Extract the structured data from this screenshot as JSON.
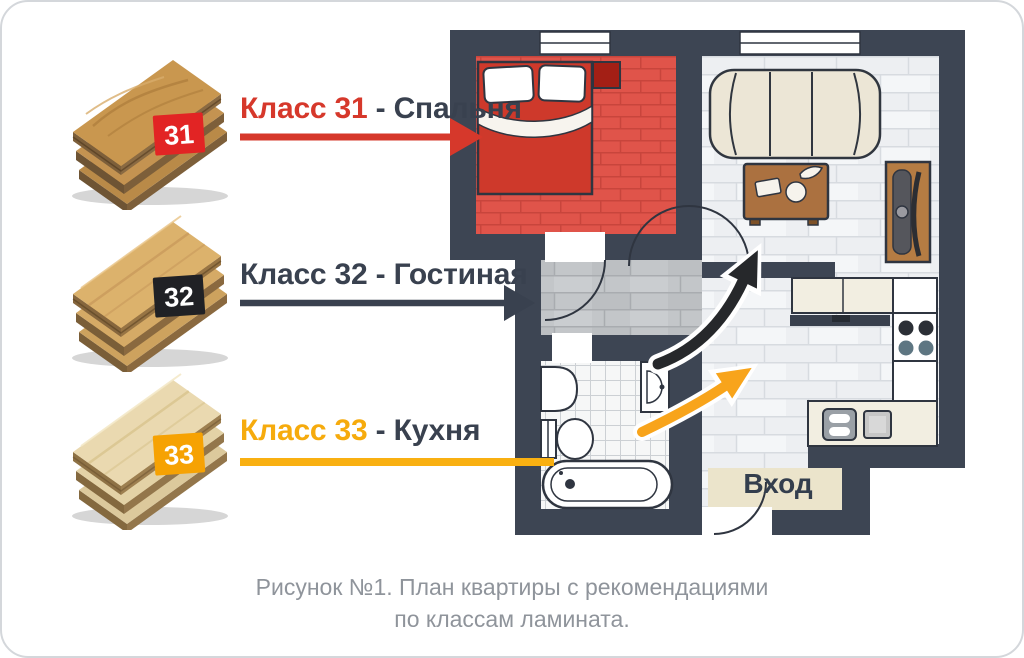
{
  "legend": {
    "items": [
      {
        "class_label": "Класс 31",
        "dash": " - ",
        "room": "Спальня",
        "badge": "31",
        "text_color": "#d6382b",
        "badge_color": "#e22424",
        "arrow_color": "#d6382b"
      },
      {
        "class_label": "Класс 32",
        "dash": " - ",
        "room": "Гостиная",
        "badge": "32",
        "text_color": "#39414f",
        "badge_color": "#202125",
        "arrow_color": "#39414f"
      },
      {
        "class_label": "Класс 33",
        "dash": " - ",
        "room": "Кухня",
        "badge": "33",
        "text_color": "#f6ab0d",
        "badge_color": "#f6a203",
        "arrow_color": "#f9b011"
      }
    ]
  },
  "floor_plan": {
    "entrance_label": "Вход",
    "wall_color": "#3d4553",
    "bedroom_floor_color": "#e0544a",
    "hallway_floor_color": "#c3c6c9",
    "living_floor_color": "#edeff2",
    "entrance_mat_color": "#ebe4cb"
  },
  "caption": {
    "line1": "Рисунок №1. План квартиры с рекомендациями",
    "line2": "по классам ламината."
  }
}
